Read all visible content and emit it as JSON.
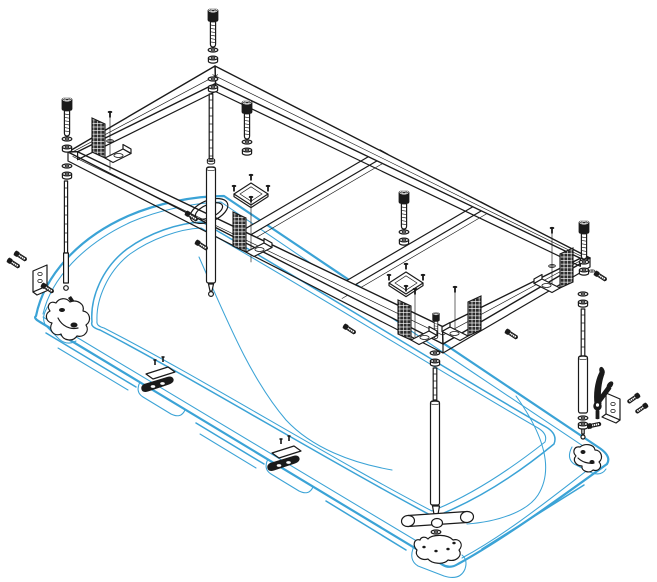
{
  "diagram": {
    "type": "exploded-assembly-drawing",
    "subject": "Bathtub support frame installation diagram",
    "colors": {
      "line": "#1a1a1a",
      "tub": "#3BA3D6",
      "background": "#ffffff",
      "hatch_bg": "#2b2b2b",
      "hatch_fg": "#ffffff"
    },
    "parts": [
      {
        "name": "support-frame",
        "qty": 1
      },
      {
        "name": "cross-member",
        "qty": 2
      },
      {
        "name": "adjustable-leg",
        "qty": 4
      },
      {
        "name": "cap-screw",
        "qty": 6
      },
      {
        "name": "washer-and-nut-set",
        "qty": 8
      },
      {
        "name": "knurled-corner-bracket",
        "qty": 5
      },
      {
        "name": "mounting-plate-with-screws",
        "qty": 2
      },
      {
        "name": "rim-clip",
        "qty": 2
      },
      {
        "name": "wall-bracket-with-screws",
        "qty": 2
      },
      {
        "name": "adjustment-lever",
        "qty": 1
      },
      {
        "name": "t-bar-foot",
        "qty": 1
      },
      {
        "name": "foot-pad",
        "qty": 3
      },
      {
        "name": "overflow-ring",
        "qty": 1
      },
      {
        "name": "bathtub",
        "qty": 1
      }
    ]
  }
}
